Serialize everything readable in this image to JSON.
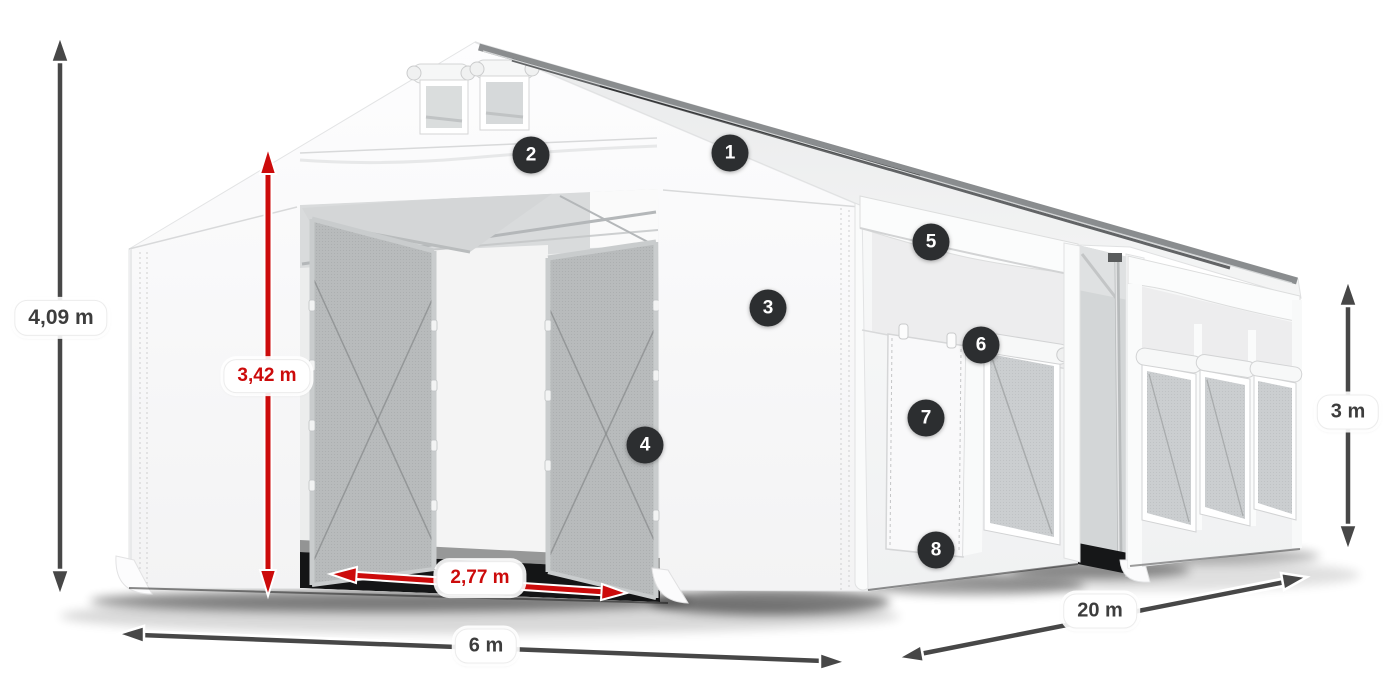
{
  "scene": {
    "description": "3D render of a white PVC storage tent, front entrance open, seen from the front-right, on white background",
    "background_color": "#ffffff"
  },
  "dimensions": [
    {
      "id": "total-height",
      "label": "4,09 m",
      "style": "dark",
      "orientation": "vertical",
      "position": "far-left"
    },
    {
      "id": "entrance-height",
      "label": "3,42 m",
      "style": "red",
      "orientation": "vertical",
      "position": "front-entrance"
    },
    {
      "id": "entrance-width",
      "label": "2,77 m",
      "style": "red",
      "orientation": "horizontal",
      "position": "front-entrance-floor"
    },
    {
      "id": "front-width",
      "label": "6 m",
      "style": "dark",
      "orientation": "horizontal",
      "position": "bottom-front"
    },
    {
      "id": "side-length",
      "label": "20 m",
      "style": "dark",
      "orientation": "diagonal",
      "position": "bottom-right-side"
    },
    {
      "id": "side-height",
      "label": "3 m",
      "style": "dark",
      "orientation": "vertical",
      "position": "far-right"
    }
  ],
  "callouts": [
    {
      "number": "1",
      "location": "roof"
    },
    {
      "number": "2",
      "location": "front-gable-band"
    },
    {
      "number": "3",
      "location": "front-right-wall"
    },
    {
      "number": "4",
      "location": "entrance-door-frame"
    },
    {
      "number": "5",
      "location": "side-upper-panel"
    },
    {
      "number": "6",
      "location": "side-window"
    },
    {
      "number": "7",
      "location": "side-door"
    },
    {
      "number": "8",
      "location": "side-door-bottom"
    }
  ],
  "colors": {
    "arrow_dark": "#474747",
    "arrow_red": "#cc0b0b",
    "badge_background": "#2c2e30",
    "badge_text": "#ffffff",
    "label_text": "#3d3d3d",
    "tent_white": "#f7f7f8",
    "mesh_gray": "#b8bbbc"
  }
}
